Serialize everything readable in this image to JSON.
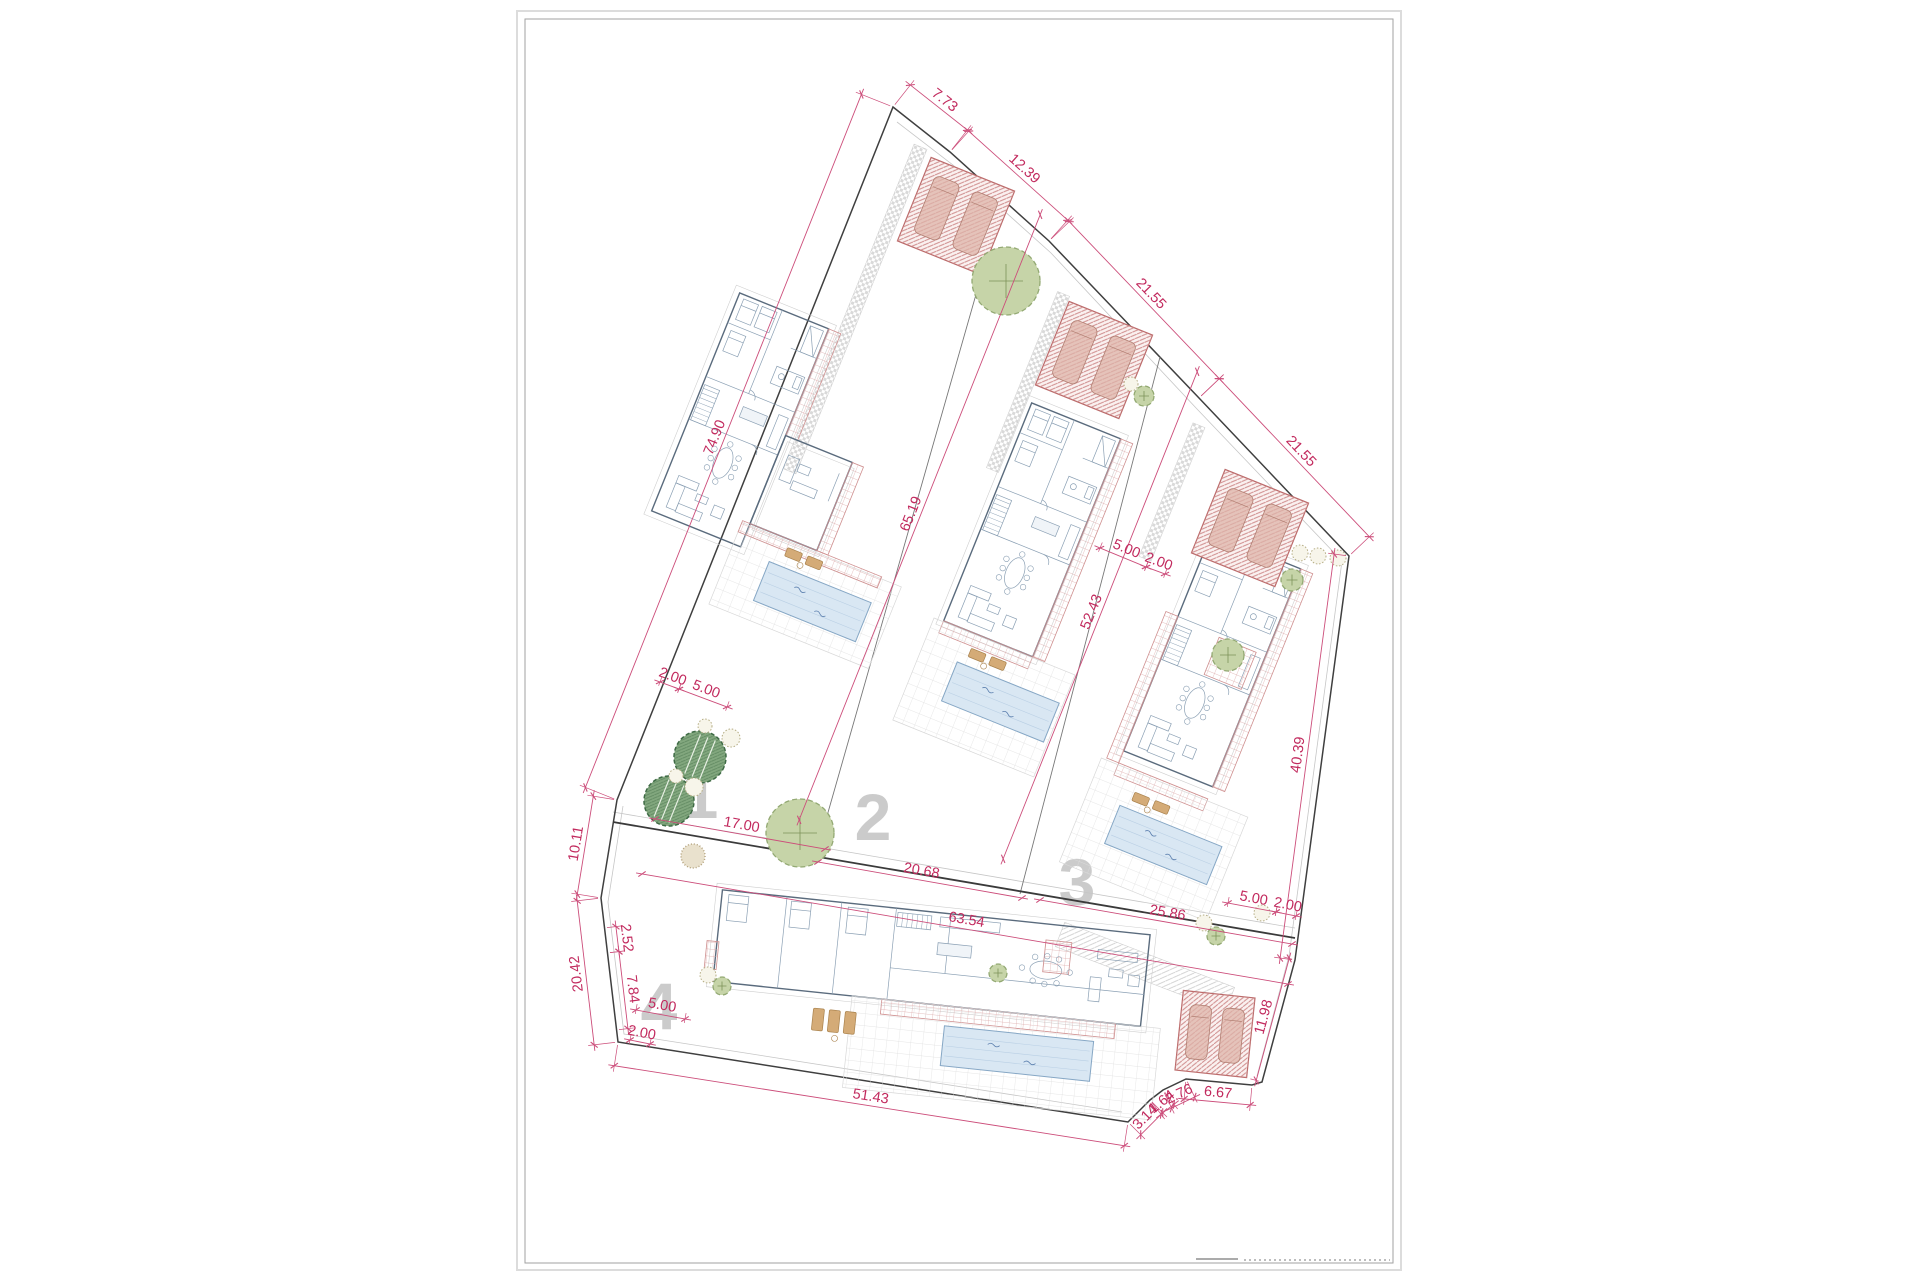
{
  "plot_numbers": [
    {
      "label": "1",
      "x": 700,
      "y": 818
    },
    {
      "label": "2",
      "x": 873,
      "y": 840
    },
    {
      "label": "3",
      "x": 1077,
      "y": 905
    },
    {
      "label": "4",
      "x": 659,
      "y": 1029
    }
  ],
  "dimensions": [
    {
      "label": "7.73",
      "x1": 893,
      "y1": 107,
      "x2": 950,
      "y2": 152,
      "off": 28,
      "ext": true
    },
    {
      "label": "12.39",
      "x1": 950,
      "y1": 152,
      "x2": 1049,
      "y2": 241,
      "off": 28,
      "ext": true
    },
    {
      "label": "21.55",
      "x1": 1049,
      "y1": 241,
      "x2": 1199,
      "y2": 398,
      "off": 28,
      "ext": true
    },
    {
      "label": "21.55",
      "x1": 1199,
      "y1": 398,
      "x2": 1349,
      "y2": 556,
      "off": 28,
      "ext": true
    },
    {
      "label": "40.39",
      "x1": 1349,
      "y1": 556,
      "x2": 1295,
      "y2": 960,
      "off": -15,
      "ext": true
    },
    {
      "label": "11.98",
      "x1": 1295,
      "y1": 960,
      "x2": 1262,
      "y2": 1082,
      "off": -6,
      "ext": true
    },
    {
      "label": "6.67",
      "x1": 1252,
      "y1": 1085,
      "x2": 1186,
      "y2": 1079,
      "off": 20,
      "ext": true
    },
    {
      "label": "2.76",
      "x1": 1186,
      "y1": 1079,
      "x2": 1163,
      "y2": 1090,
      "off": 20,
      "ext": true
    },
    {
      "label": "1.64",
      "x1": 1163,
      "y1": 1090,
      "x2": 1150,
      "y2": 1100,
      "off": 18,
      "ext": true
    },
    {
      "label": "3.14",
      "x1": 1150,
      "y1": 1100,
      "x2": 1128,
      "y2": 1122,
      "off": 18,
      "ext": true
    },
    {
      "label": "51.43",
      "x1": 1128,
      "y1": 1122,
      "x2": 618,
      "y2": 1042,
      "off": 24,
      "ext": true
    },
    {
      "label": "20.42",
      "x1": 618,
      "y1": 1042,
      "x2": 601,
      "y2": 898,
      "off": 24,
      "ext": true
    },
    {
      "label": "10.11",
      "x1": 601,
      "y1": 898,
      "x2": 617,
      "y2": 800,
      "off": 24,
      "ext": true
    },
    {
      "label": "74.90",
      "x1": 617,
      "y1": 800,
      "x2": 893,
      "y2": 107,
      "off": 34,
      "ext": true
    },
    {
      "label": "65.19",
      "x1": 1003,
      "y1": 200,
      "x2": 762,
      "y2": 805,
      "off": 40,
      "ext": false
    },
    {
      "label": "52.43",
      "x1": 1160,
      "y1": 357,
      "x2": 966,
      "y2": 844,
      "off": 40,
      "ext": false
    },
    {
      "label": "20.68",
      "x1": 818,
      "y1": 862,
      "x2": 1022,
      "y2": 898,
      "off": 0,
      "ext": false
    },
    {
      "label": "63.54",
      "x1": 642,
      "y1": 874,
      "x2": 1288,
      "y2": 984,
      "off": 0,
      "ext": false
    },
    {
      "label": "25.86",
      "x1": 1040,
      "y1": 900,
      "x2": 1292,
      "y2": 944,
      "off": 0,
      "ext": false
    },
    {
      "label": "17.00",
      "x1": 655,
      "y1": 819,
      "x2": 825,
      "y2": 849,
      "off": 0,
      "ext": false
    },
    {
      "label": "2.00",
      "x1": 660,
      "y1": 682,
      "x2": 679,
      "y2": 689,
      "off": 0,
      "ext": true
    },
    {
      "label": "5.00",
      "x1": 679,
      "y1": 689,
      "x2": 727,
      "y2": 707,
      "off": 0,
      "ext": true
    },
    {
      "label": "5.00",
      "x1": 1100,
      "y1": 548,
      "x2": 1146,
      "y2": 567,
      "off": 0,
      "ext": true
    },
    {
      "label": "2.00",
      "x1": 1146,
      "y1": 567,
      "x2": 1165,
      "y2": 574,
      "off": 0,
      "ext": true
    },
    {
      "label": "5.00",
      "x1": 1228,
      "y1": 903,
      "x2": 1276,
      "y2": 912,
      "off": 0,
      "ext": true
    },
    {
      "label": "2.00",
      "x1": 1276,
      "y1": 912,
      "x2": 1296,
      "y2": 916,
      "off": 0,
      "ext": true
    },
    {
      "label": "2.52",
      "x1": 604,
      "y1": 928,
      "x2": 607,
      "y2": 953,
      "off": 12,
      "ext": true
    },
    {
      "label": "7.84",
      "x1": 607,
      "y1": 953,
      "x2": 616,
      "y2": 1030,
      "off": 12,
      "ext": true
    },
    {
      "label": "5.00",
      "x1": 636,
      "y1": 1010,
      "x2": 685,
      "y2": 1019,
      "off": 0,
      "ext": true
    },
    {
      "label": "2.00",
      "x1": 630,
      "y1": 1040,
      "x2": 650,
      "y2": 1044,
      "off": 0,
      "ext": true
    }
  ],
  "colors": {
    "dimension_text": "#c22a5e",
    "dimension_line": "#cc4d7a",
    "boundary": "#3f3f3f",
    "divider": "#787878",
    "plot_number": "#c6c6c6",
    "red_hatch": "#cf8d8d",
    "pool_fill": "#d9e7f3",
    "pool_edge": "#86a7c5",
    "tree_dark": "#82a77e",
    "tree_light": "#c6d4a8",
    "paper_frame": "#a2a2a2"
  }
}
